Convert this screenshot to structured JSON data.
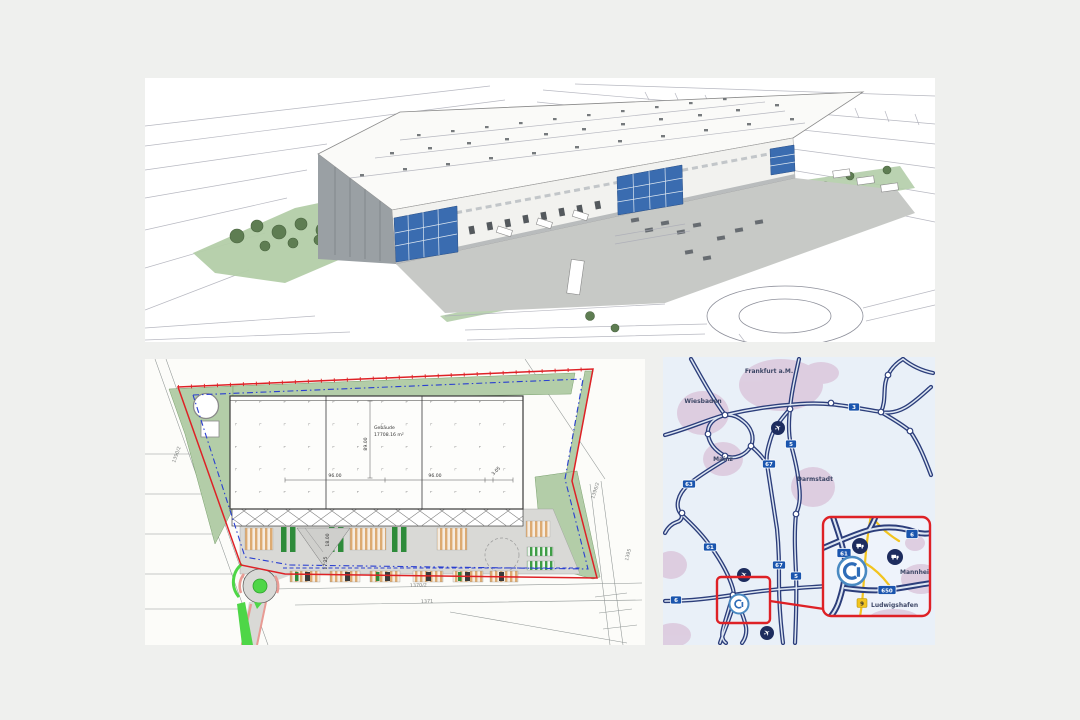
{
  "canvas": {
    "bg": "#eff0ee"
  },
  "colors": {
    "boundary_red": "#de2126",
    "easement_blue": "#2a3fd0",
    "landscape_green": "#b3cda8",
    "bright_green": "#4ed647",
    "road_navy": "#2c3e7b",
    "badge_blue": "#1a55ae",
    "badge_yellow": "#f2c41f",
    "city_blob": "#dccade",
    "office_blue": "#3a6cb0",
    "curb_salmon": "#e89b94",
    "court_gray": "#d9d9d6"
  },
  "site_plan": {
    "building": {
      "name": "Gebäude",
      "area": "17708.16 m²"
    },
    "dimensions": {
      "width_left": "96.00",
      "width_right": "96.00",
      "edge": "3.05",
      "depth": "89.00",
      "court_depth": "18.00",
      "court_inner": "17.25"
    },
    "parcels": [
      "1390/2",
      "1396/2",
      "1395",
      "1370/2",
      "1371"
    ]
  },
  "map": {
    "cities": [
      "Frankfurt a.M.",
      "Wiesbaden",
      "Mainz",
      "Darmstadt"
    ],
    "badges": [
      "3",
      "5",
      "67",
      "63",
      "61",
      "6",
      "67",
      "5"
    ],
    "inset": {
      "cities": [
        "Mannheim",
        "Ludwigshafen"
      ],
      "badges": [
        "61",
        "6",
        "650",
        "9"
      ]
    },
    "icons": {
      "airport_glyph": "✈"
    }
  }
}
